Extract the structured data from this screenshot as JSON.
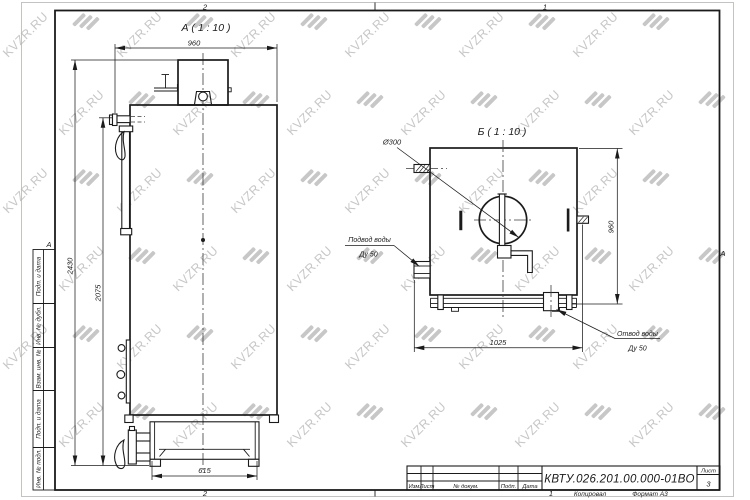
{
  "watermark": {
    "text": "KVZR.RU",
    "color": "#c7c7c7"
  },
  "frame": {
    "zone_top_left": "2",
    "zone_top_right": "1",
    "zone_bottom_left": "2",
    "zone_bottom_right": "1",
    "zone_letter_left": "A",
    "zone_letter_right": "A",
    "copied_label": "Копировал",
    "format_label": "Формат А3"
  },
  "margin_column": {
    "labels": [
      "Подп. и дата",
      "Инв. № дубл.",
      "Взам. инв. №",
      "Подп. и дата",
      "Инв. № подл."
    ]
  },
  "title_block": {
    "doc_number": "КВТУ.026.201.00.000-01ВО",
    "columns": [
      "Изм",
      "Лист",
      "№ докум.",
      "Подп.",
      "Дата"
    ],
    "sheet_label": "Лист",
    "sheet_value": "3"
  },
  "view_a": {
    "title": "А ( 1 : 10 )",
    "dim_width_top": "960",
    "dim_height_total": "2430",
    "dim_height_body": "2075",
    "dim_base_width": "615"
  },
  "view_b": {
    "title": "Б ( 1 : 10 )",
    "dim_diameter": "Ø300",
    "dim_height": "960",
    "dim_width": "1025",
    "inlet_line1": "Подвод воды",
    "inlet_line2": "Ду 50",
    "outlet_line1": "Отвод воды",
    "outlet_line2": "Ду 50"
  }
}
